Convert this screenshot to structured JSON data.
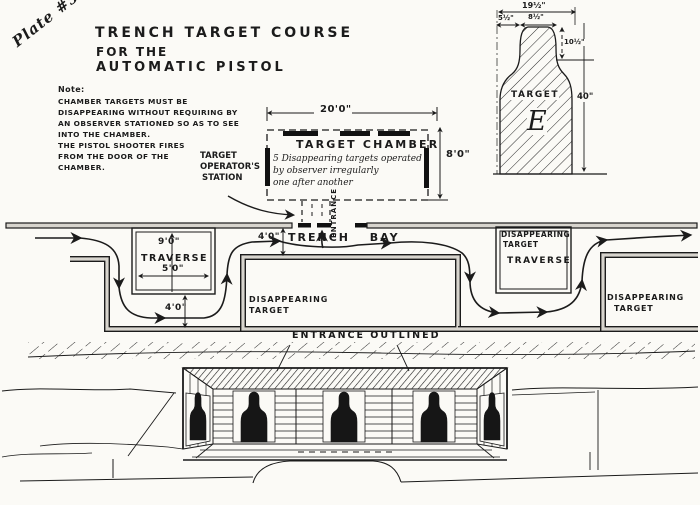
{
  "plate": {
    "label": "Plate #5"
  },
  "title": {
    "line1": "TRENCH TARGET COURSE",
    "line2": "FOR THE",
    "line3": "AUTOMATIC PISTOL"
  },
  "note": {
    "heading": "Note:",
    "lines": [
      "CHAMBER TARGETS MUST BE",
      "DISAPPEARING WITHOUT REQUIRING BY",
      "AN OBSERVER STATIONED SO AS TO SEE",
      "INTO THE CHAMBER.",
      "THE PISTOL SHOOTER FIRES",
      "FROM THE DOOR OF THE",
      "CHAMBER."
    ]
  },
  "chamber": {
    "title": "TARGET CHAMBER",
    "desc1": "5 Disappearing targets operated",
    "desc2": "by observer   irregularly",
    "desc3": "one after another",
    "width_dim": "20'0\"",
    "height_dim": "8'0\""
  },
  "operator_station": {
    "line1": "TARGET",
    "line2": "OPERATOR'S",
    "line3": "STATION"
  },
  "trench": {
    "bay_label": "TRENCH  BAY",
    "bay_width_dim": "4'0\"",
    "entrance_label": "ENTRANCE",
    "left_traverse": {
      "label": "TRAVERSE",
      "depth_dim": "9'0\"",
      "width_dim": "5'0\"",
      "channel_dim": "4'0\""
    },
    "right_traverse": {
      "label": "TRAVERSE",
      "target_line1": "DISAPPEARING",
      "target_line2": "TARGET"
    },
    "disappearing_left": {
      "line1": "DISAPPEARING",
      "line2": "TARGET"
    },
    "disappearing_right": {
      "line1": "DISAPPEARING",
      "line2": "TARGET"
    }
  },
  "section_view": {
    "entrance_label": "ENTRANCE OUTLINED"
  },
  "target_e": {
    "label": "TARGET",
    "letter": "E",
    "width_dim": "19½\"",
    "offset_dim": "5½\"",
    "head_width_dim": "8½\"",
    "head_height_dim": "10½\"",
    "height_dim": "40\""
  }
}
